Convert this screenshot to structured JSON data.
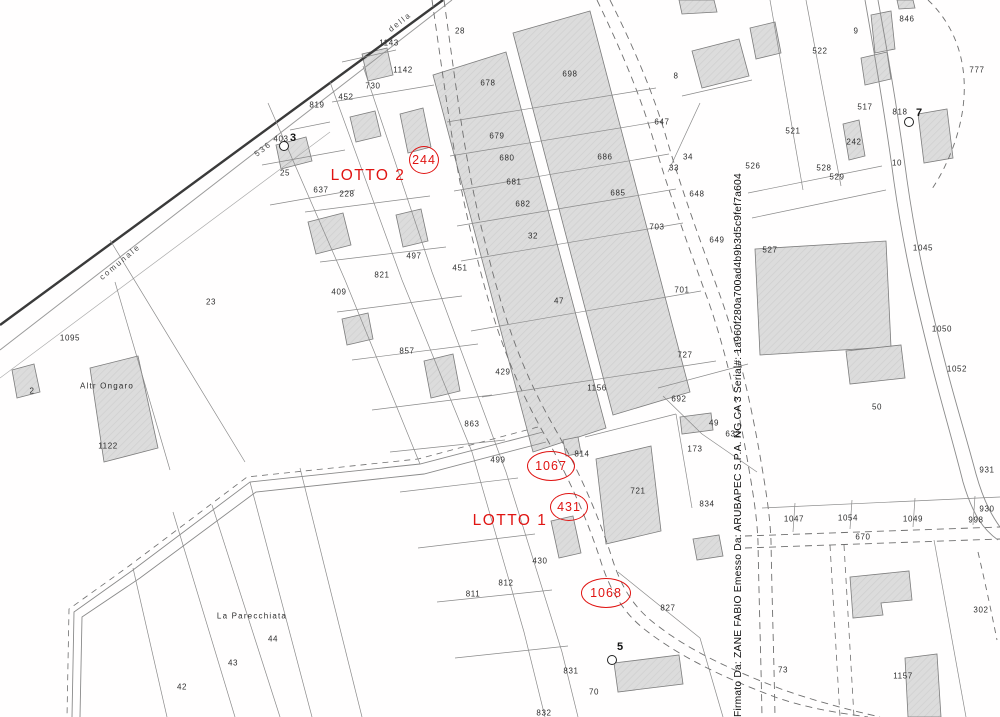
{
  "colors": {
    "red": "#e01412",
    "line": "#8a8a8a",
    "road_dark": "#3a3a3a",
    "building_fill": "#d8d8d8"
  },
  "map": {
    "signature": {
      "text": "Firmato Da: ZANE FABIO Emesso Da: ARUBAPEC S.P.A. NG CA 3 Serial#: 1a960f280a700ad4b9b3d5c9fef7a604",
      "x": 733
    },
    "road_labels": [
      {
        "t": "della",
        "x": 400,
        "y": 22,
        "rot": -38
      },
      {
        "t": "comunale",
        "x": 120,
        "y": 262,
        "rot": -40
      },
      {
        "t": "536",
        "x": 263,
        "y": 149,
        "rot": -38
      }
    ],
    "place_labels": [
      {
        "t": "La Parecchiata",
        "x": 252,
        "y": 616
      },
      {
        "t": "Altr Ongaro",
        "x": 107,
        "y": 386
      }
    ],
    "parcel_labels": [
      {
        "t": "28",
        "x": 460,
        "y": 31
      },
      {
        "t": "1143",
        "x": 389,
        "y": 43
      },
      {
        "t": "1142",
        "x": 403,
        "y": 70
      },
      {
        "t": "730",
        "x": 373,
        "y": 86
      },
      {
        "t": "452",
        "x": 346,
        "y": 97
      },
      {
        "t": "819",
        "x": 317,
        "y": 105
      },
      {
        "t": "403",
        "x": 281,
        "y": 139
      },
      {
        "t": "25",
        "x": 285,
        "y": 173
      },
      {
        "t": "637",
        "x": 321,
        "y": 190
      },
      {
        "t": "228",
        "x": 347,
        "y": 194
      },
      {
        "t": "678",
        "x": 488,
        "y": 83
      },
      {
        "t": "698",
        "x": 570,
        "y": 74
      },
      {
        "t": "679",
        "x": 497,
        "y": 136
      },
      {
        "t": "680",
        "x": 507,
        "y": 158
      },
      {
        "t": "686",
        "x": 605,
        "y": 157
      },
      {
        "t": "681",
        "x": 514,
        "y": 182
      },
      {
        "t": "685",
        "x": 618,
        "y": 193
      },
      {
        "t": "682",
        "x": 523,
        "y": 204
      },
      {
        "t": "32",
        "x": 533,
        "y": 236
      },
      {
        "t": "47",
        "x": 559,
        "y": 301
      },
      {
        "t": "1156",
        "x": 597,
        "y": 388
      },
      {
        "t": "703",
        "x": 657,
        "y": 227
      },
      {
        "t": "647",
        "x": 662,
        "y": 122
      },
      {
        "t": "648",
        "x": 697,
        "y": 194
      },
      {
        "t": "649",
        "x": 717,
        "y": 240
      },
      {
        "t": "701",
        "x": 682,
        "y": 290
      },
      {
        "t": "727",
        "x": 685,
        "y": 355
      },
      {
        "t": "8",
        "x": 676,
        "y": 76
      },
      {
        "t": "34",
        "x": 688,
        "y": 157
      },
      {
        "t": "33",
        "x": 674,
        "y": 168
      },
      {
        "t": "9",
        "x": 856,
        "y": 31
      },
      {
        "t": "846",
        "x": 907,
        "y": 19
      },
      {
        "t": "522",
        "x": 820,
        "y": 51
      },
      {
        "t": "777",
        "x": 977,
        "y": 70
      },
      {
        "t": "521",
        "x": 793,
        "y": 131
      },
      {
        "t": "517",
        "x": 865,
        "y": 107
      },
      {
        "t": "818",
        "x": 900,
        "y": 112
      },
      {
        "t": "242",
        "x": 854,
        "y": 142
      },
      {
        "t": "528",
        "x": 824,
        "y": 168
      },
      {
        "t": "526",
        "x": 753,
        "y": 166
      },
      {
        "t": "529",
        "x": 837,
        "y": 177
      },
      {
        "t": "10",
        "x": 897,
        "y": 163
      },
      {
        "t": "527",
        "x": 770,
        "y": 250
      },
      {
        "t": "1045",
        "x": 923,
        "y": 248
      },
      {
        "t": "1050",
        "x": 942,
        "y": 329
      },
      {
        "t": "1052",
        "x": 957,
        "y": 369
      },
      {
        "t": "50",
        "x": 877,
        "y": 407
      },
      {
        "t": "23",
        "x": 211,
        "y": 302
      },
      {
        "t": "1095",
        "x": 70,
        "y": 338
      },
      {
        "t": "2",
        "x": 32,
        "y": 391
      },
      {
        "t": "1122",
        "x": 108,
        "y": 446
      },
      {
        "t": "409",
        "x": 339,
        "y": 292
      },
      {
        "t": "821",
        "x": 382,
        "y": 275
      },
      {
        "t": "497",
        "x": 414,
        "y": 256
      },
      {
        "t": "451",
        "x": 460,
        "y": 268
      },
      {
        "t": "857",
        "x": 407,
        "y": 351
      },
      {
        "t": "863",
        "x": 472,
        "y": 424
      },
      {
        "t": "429",
        "x": 503,
        "y": 372
      },
      {
        "t": "499",
        "x": 498,
        "y": 460
      },
      {
        "t": "814",
        "x": 582,
        "y": 454
      },
      {
        "t": "721",
        "x": 638,
        "y": 491
      },
      {
        "t": "692",
        "x": 679,
        "y": 399
      },
      {
        "t": "49",
        "x": 714,
        "y": 423
      },
      {
        "t": "632",
        "x": 733,
        "y": 434
      },
      {
        "t": "173",
        "x": 695,
        "y": 449
      },
      {
        "t": "834",
        "x": 707,
        "y": 504
      },
      {
        "t": "931",
        "x": 987,
        "y": 470
      },
      {
        "t": "930",
        "x": 987,
        "y": 509
      },
      {
        "t": "1047",
        "x": 794,
        "y": 519
      },
      {
        "t": "1054",
        "x": 848,
        "y": 518
      },
      {
        "t": "1049",
        "x": 913,
        "y": 519
      },
      {
        "t": "998",
        "x": 976,
        "y": 520
      },
      {
        "t": "670",
        "x": 863,
        "y": 537
      },
      {
        "t": "302",
        "x": 981,
        "y": 610
      },
      {
        "t": "1157",
        "x": 903,
        "y": 676
      },
      {
        "t": "827",
        "x": 668,
        "y": 608
      },
      {
        "t": "73",
        "x": 783,
        "y": 670
      },
      {
        "t": "430",
        "x": 540,
        "y": 561
      },
      {
        "t": "812",
        "x": 506,
        "y": 583
      },
      {
        "t": "811",
        "x": 473,
        "y": 594
      },
      {
        "t": "831",
        "x": 571,
        "y": 671
      },
      {
        "t": "832",
        "x": 544,
        "y": 713
      },
      {
        "t": "70",
        "x": 594,
        "y": 692
      },
      {
        "t": "44",
        "x": 273,
        "y": 639
      },
      {
        "t": "43",
        "x": 233,
        "y": 663
      },
      {
        "t": "42",
        "x": 182,
        "y": 687
      }
    ],
    "point_markers": [
      {
        "n": "3",
        "x": 293,
        "y": 138,
        "cx": 284,
        "cy": 146
      },
      {
        "n": "7",
        "x": 919,
        "y": 113,
        "cx": 909,
        "cy": 122
      },
      {
        "n": "5",
        "x": 620,
        "y": 647,
        "cx": 612,
        "cy": 660
      }
    ],
    "red": {
      "annotations": [
        {
          "t": "244",
          "cx": 424,
          "cy": 160,
          "rx": 14,
          "ry": 13
        },
        {
          "t": "1067",
          "cx": 551,
          "cy": 466,
          "rx": 23,
          "ry": 14
        },
        {
          "t": "431",
          "cx": 569,
          "cy": 507,
          "rx": 18,
          "ry": 13
        },
        {
          "t": "1068",
          "cx": 606,
          "cy": 593,
          "rx": 24,
          "ry": 14
        }
      ],
      "lotto_labels": [
        {
          "t": "LOTTO 2",
          "x": 368,
          "y": 176
        },
        {
          "t": "LOTTO 1",
          "x": 510,
          "y": 521
        }
      ]
    }
  }
}
